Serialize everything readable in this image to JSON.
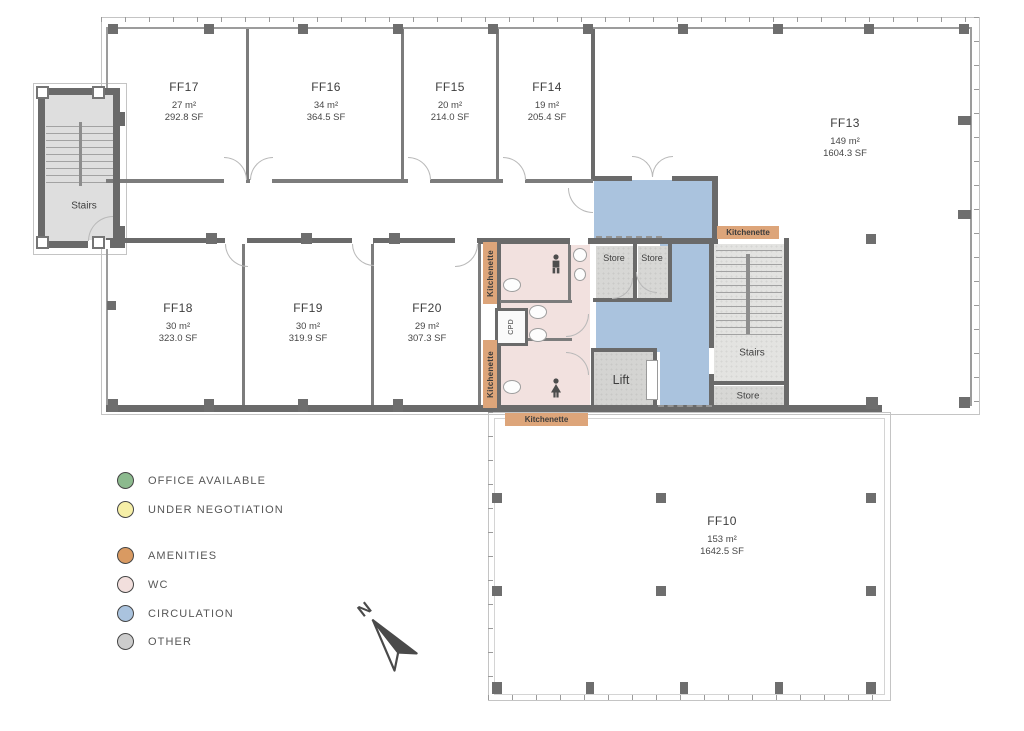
{
  "plan": {
    "rooms": [
      {
        "id": "FF17",
        "area_m2": "27 m²",
        "area_sf": "292.8 SF"
      },
      {
        "id": "FF16",
        "area_m2": "34 m²",
        "area_sf": "364.5 SF"
      },
      {
        "id": "FF15",
        "area_m2": "20 m²",
        "area_sf": "214.0 SF"
      },
      {
        "id": "FF14",
        "area_m2": "19 m²",
        "area_sf": "205.4 SF"
      },
      {
        "id": "FF13",
        "area_m2": "149 m²",
        "area_sf": "1604.3 SF"
      },
      {
        "id": "FF18",
        "area_m2": "30 m²",
        "area_sf": "323.0 SF"
      },
      {
        "id": "FF19",
        "area_m2": "30 m²",
        "area_sf": "319.9 SF"
      },
      {
        "id": "FF20",
        "area_m2": "29 m²",
        "area_sf": "307.3 SF"
      },
      {
        "id": "FF10",
        "area_m2": "153 m²",
        "area_sf": "1642.5 SF"
      }
    ],
    "labels": {
      "stairs": "Stairs",
      "store": "Store",
      "lift": "Lift",
      "cpd": "CPD",
      "kitchenette": "Kitchenette",
      "north": "N"
    }
  },
  "legend": {
    "items": [
      {
        "label": "OFFICE AVAILABLE",
        "color": "#8cba8e"
      },
      {
        "label": "UNDER NEGOTIATION",
        "color": "#f6efa7"
      },
      {
        "label": "AMENITIES",
        "color": "#d99a62"
      },
      {
        "label": "WC",
        "color": "#f2dfdd"
      },
      {
        "label": "CIRCULATION",
        "color": "#aac3de"
      },
      {
        "label": "OTHER",
        "color": "#cccccc"
      }
    ]
  },
  "colors": {
    "wall": "#6a6a6a",
    "circulation": "#aac3de",
    "wc": "#f2e1df",
    "amenity": "#dda57a",
    "store": "#d7d7d5",
    "stairs": "#e3e3e1",
    "lift": "#d4d4d2",
    "tower": "#dedede"
  }
}
